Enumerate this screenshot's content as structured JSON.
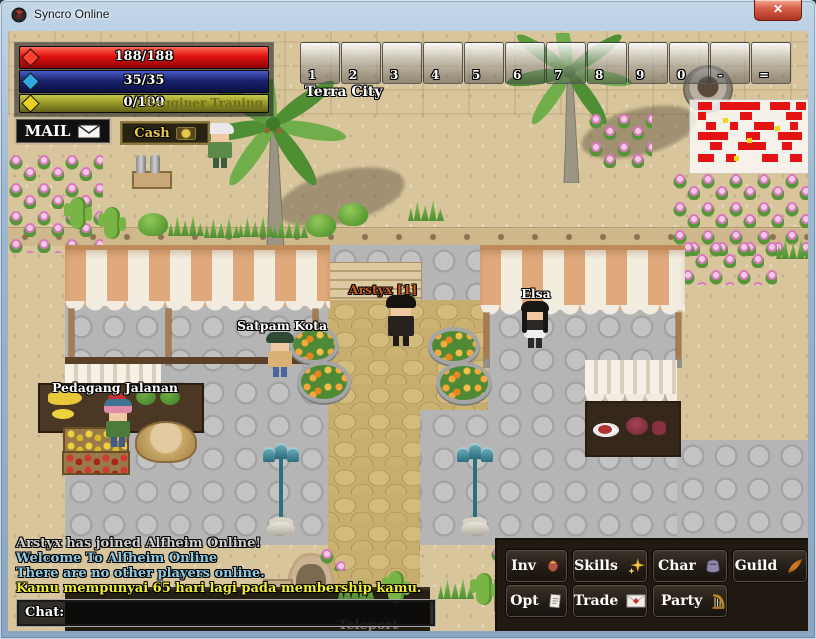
{
  "window": {
    "title": "Syncro Online",
    "close_glyph": "✕"
  },
  "hud": {
    "hp": "188/188",
    "mp": "35/35",
    "xp": "0/100",
    "xp_quest": "Begginer Traning",
    "mail": "MAIL",
    "cash": "Cash"
  },
  "hotbar": {
    "keys": [
      "1",
      "2",
      "3",
      "4",
      "5",
      "6",
      "7",
      "8",
      "9",
      "0",
      "-",
      "="
    ]
  },
  "location": "Terra City",
  "entities": {
    "player": {
      "name": "Arstyx [1]",
      "name_color": "#c25e1e"
    },
    "npcs": {
      "guard": "Satpam Kota",
      "shop_girl": "Elsa",
      "street_vendor": "Pedagang Jalanan"
    }
  },
  "chat": {
    "lines": [
      {
        "text": "Arstyx has joined Alfheim Online!",
        "color": "#cfcfcf"
      },
      {
        "text": "Welcome To Alfheim Online",
        "color": "#8ec9e2"
      },
      {
        "text": "There are no other players online.",
        "color": "#8ec9e2"
      },
      {
        "text": "Kamu mempunyai 65 hari lagi pada membership kamu.",
        "color": "#f0ee30"
      }
    ],
    "input_label": "Chat:"
  },
  "menu": {
    "inv": "Inv",
    "skills": "Skills",
    "char": "Char",
    "guild": "Guild",
    "opt": "Opt",
    "trade": "Trade",
    "party": "Party"
  },
  "map_overlay": {
    "teleport": "Teleport"
  },
  "colors": {
    "hp_bar": "#e01010",
    "mp_bar": "#1a2470",
    "xp_bar": "#9a9a28",
    "player_name": "#c25e1e",
    "minimap_block": "#e41414",
    "minimap_dot": "#f2d90e"
  }
}
